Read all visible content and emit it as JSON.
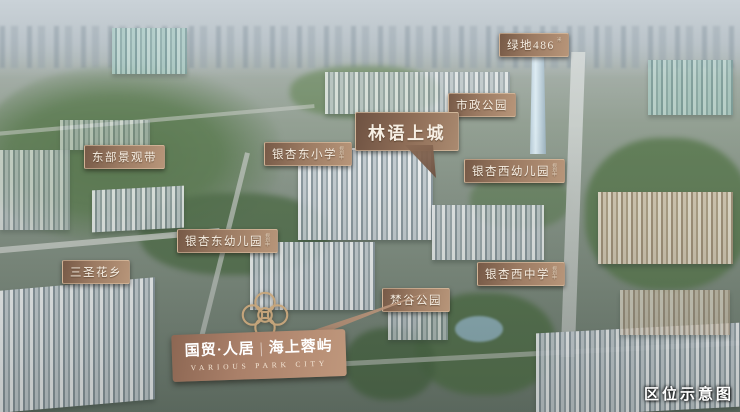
{
  "corner_caption": "区位示意图",
  "labels": [
    {
      "id": "greenland-tower",
      "text": "绿地486",
      "note": "米"
    },
    {
      "id": "municipal-park",
      "text": "市政公园",
      "note": ""
    },
    {
      "id": "linyu-shangcheng",
      "text": "林语上城",
      "note": ""
    },
    {
      "id": "east-landscape-belt",
      "text": "东部景观带",
      "note": ""
    },
    {
      "id": "yinxing-east-primary",
      "text": "银杏东小学",
      "note": "规划中"
    },
    {
      "id": "yinxing-west-kindergarten",
      "text": "银杏西幼儿园",
      "note": "规划中"
    },
    {
      "id": "yinxing-east-kindergarten",
      "text": "银杏东幼儿园",
      "note": "规划中"
    },
    {
      "id": "sansheng-flower-town",
      "text": "三圣花乡",
      "note": ""
    },
    {
      "id": "yinxing-west-middle",
      "text": "银杏西中学",
      "note": "规划中"
    },
    {
      "id": "fangu-park",
      "text": "梵谷公园",
      "note": ""
    }
  ],
  "project_badge": {
    "name_cn_left": "国贸·人居",
    "divider": "|",
    "name_cn_right": "海上蓉屿",
    "name_en": "VARIOUS PARK CITY"
  },
  "colors": {
    "label_bg_from": "#775a47",
    "label_bg_to": "#b79579",
    "label_text": "#f7efe4",
    "badge_bg_from": "#8d6753",
    "badge_bg_to": "#bf977c",
    "logo_gold": "#caa87d",
    "caption_text": "#ffffff"
  }
}
